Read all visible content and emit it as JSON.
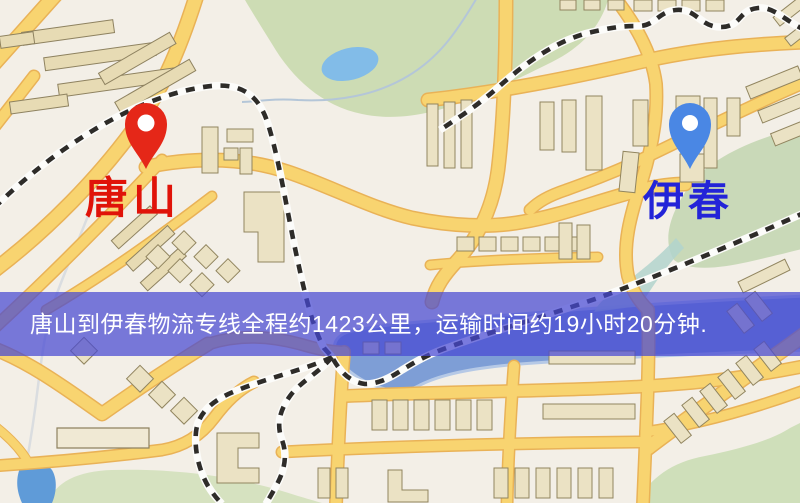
{
  "map": {
    "origin": {
      "label": "唐山",
      "pin_color": "#e52718",
      "label_color": "#e01309"
    },
    "destination": {
      "label": "伊春",
      "pin_color": "#4a87e4",
      "label_color": "#2324d8"
    },
    "banner": {
      "text": "唐山到伊春物流专线全程约1423公里，运输时间约19小时20分钟.",
      "background": "#4648d2",
      "background_opacity": "0.72",
      "text_color": "#ffffff"
    },
    "palette": {
      "map_background": "#f3efe7",
      "road_fill": "#f8d470",
      "road_casing": "#e9b257",
      "railway": "#2e2c29",
      "park_green": "#cddcb4",
      "water_blue": "#7e9ed6",
      "pond_blue": "#82bce8",
      "building_fill": "#ebe2c4"
    }
  }
}
